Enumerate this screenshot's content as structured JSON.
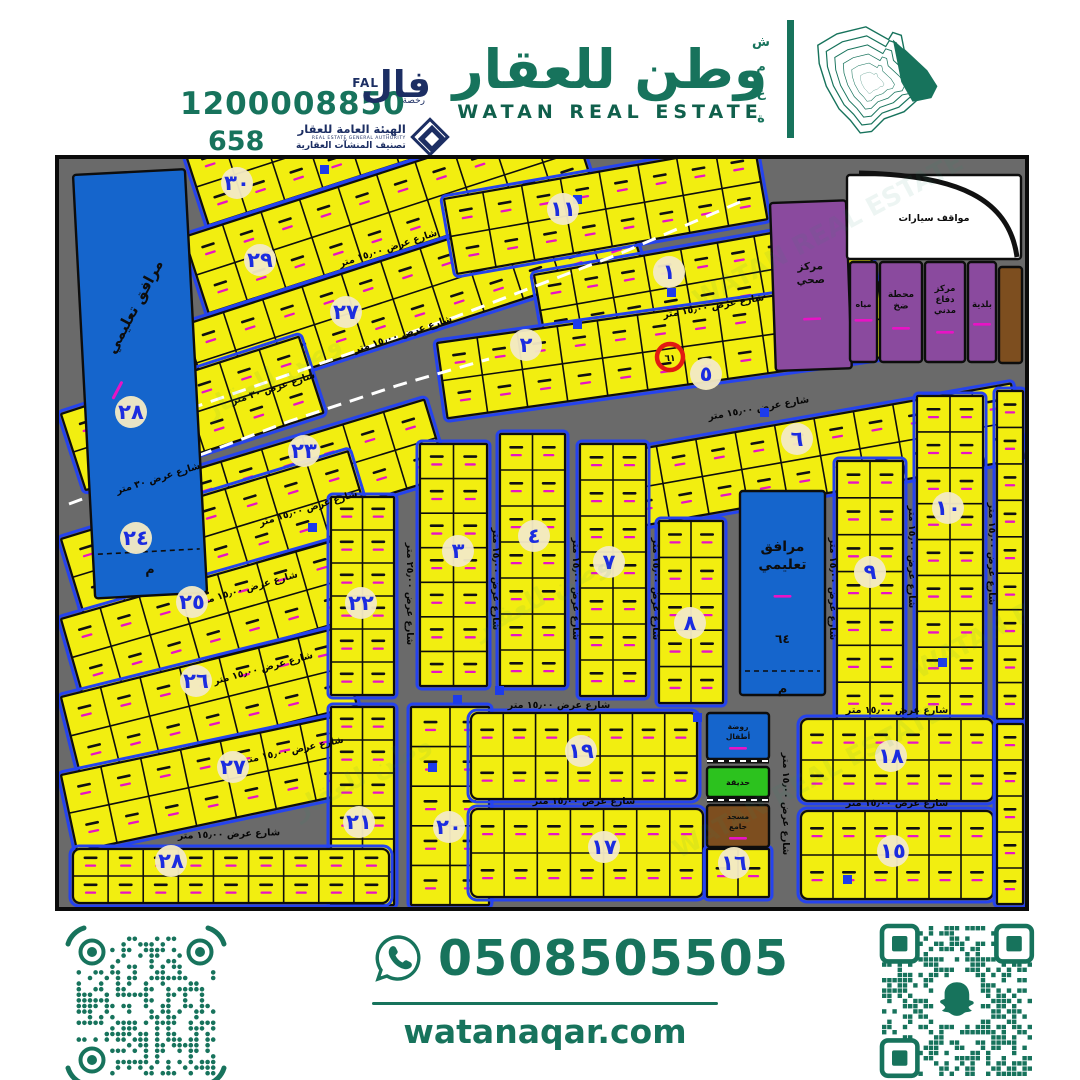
{
  "header": {
    "phone_big": "1200008850",
    "license_number": "658",
    "fal": {
      "ar": "فال",
      "en": "FAL",
      "sub": "رخصة"
    },
    "rega": {
      "line1_ar": "الهيئة العامة للعقار",
      "line1_en": "REAL ESTATE GENERAL AUTHORITY",
      "line2_ar": "تصنيف المنشآت العقارية"
    },
    "brand_ar": "وطن للعقار",
    "brand_en": "WATAN REAL ESTATE",
    "side_word_letters": [
      "ش",
      "م",
      "ع",
      "ة"
    ]
  },
  "footer": {
    "whatsapp_number": "0508505505",
    "website": "watanaqar.com"
  },
  "colors": {
    "brand_green": "#17735c",
    "map_gray": "#6a6a6a",
    "plot_yellow": "#f2ee10",
    "blue_parcel": "#1565cc",
    "purple_parcel": "#8a4a9e",
    "brown_parcel": "#7d4e1f",
    "park_green": "#2cc21e",
    "white_parcel": "#ffffff",
    "block_circle_fill": "#f2e9c5",
    "block_number_blue": "#1b2ce0",
    "area_magenta": "#e813c5",
    "street_edge_blue": "#2543ee",
    "highlight_red": "#e21b12"
  },
  "map": {
    "street_labels_text": {
      "w15": "شارع عرض ١٥٫٠٠ متر",
      "w25": "شارع عرض ٢٥٫٠٠ متر",
      "w30": "شارع عرض ٣٠ متر"
    },
    "street_labels": [
      [
        "w15",
        330,
        92,
        -18
      ],
      [
        "w15",
        345,
        178,
        -18
      ],
      [
        "w30",
        215,
        232,
        -18
      ],
      [
        "w30",
        100,
        322,
        -17
      ],
      [
        "w15",
        250,
        352,
        -17
      ],
      [
        "w15",
        190,
        432,
        -16
      ],
      [
        "w15",
        205,
        512,
        -15
      ],
      [
        "w15",
        235,
        594,
        -12
      ],
      [
        "w15",
        170,
        678,
        -2
      ],
      [
        "w15",
        655,
        150,
        -10
      ],
      [
        "w15",
        700,
        252,
        -10
      ],
      [
        "w15",
        500,
        549,
        0
      ],
      [
        "w15",
        525,
        645,
        0
      ],
      [
        "w15",
        838,
        554,
        0
      ],
      [
        "w15",
        838,
        647,
        0
      ],
      [
        "w25",
        348,
        435,
        90
      ],
      [
        "w15",
        434,
        420,
        90
      ],
      [
        "w15",
        514,
        430,
        90
      ],
      [
        "w15",
        594,
        430,
        90
      ],
      [
        "w15",
        771,
        430,
        90
      ],
      [
        "w15",
        850,
        398,
        90
      ],
      [
        "w15",
        930,
        395,
        90
      ],
      [
        "w15",
        724,
        645,
        90
      ]
    ],
    "block_circles": [
      [
        "٣٠",
        178,
        24
      ],
      [
        "١١",
        504,
        50
      ],
      [
        "٢٩",
        201,
        101
      ],
      [
        "١",
        610,
        113
      ],
      [
        "٢٧",
        287,
        153
      ],
      [
        "٢",
        467,
        186
      ],
      [
        "٥",
        647,
        215
      ],
      [
        "٢٨",
        72,
        253
      ],
      [
        "٢٣",
        245,
        292
      ],
      [
        "٦",
        738,
        280
      ],
      [
        "١٠",
        889,
        349
      ],
      [
        "٢٤",
        77,
        379
      ],
      [
        "٤",
        475,
        377
      ],
      [
        "٣",
        399,
        392
      ],
      [
        "٧",
        550,
        403
      ],
      [
        "٩",
        811,
        413
      ],
      [
        "٢٥",
        133,
        443
      ],
      [
        "٢٢",
        302,
        444
      ],
      [
        "٨",
        631,
        464
      ],
      [
        "٢٦",
        137,
        522
      ],
      [
        "٢٧",
        174,
        608
      ],
      [
        "١٩",
        522,
        592
      ],
      [
        "١٨",
        832,
        597
      ],
      [
        "٢١",
        300,
        663
      ],
      [
        "٢٠",
        390,
        668
      ],
      [
        "١٥",
        834,
        692
      ],
      [
        "١٧",
        545,
        688
      ],
      [
        "١٦",
        675,
        704
      ],
      [
        "٢٨",
        112,
        702
      ]
    ],
    "highlight": {
      "plot_number": "٦١",
      "x": 611,
      "y": 198
    },
    "facilities": {
      "edu_label": "مرافق تعليمي",
      "edu_center_num": "٦٤",
      "meem": "م",
      "health_center": "مركز صحي",
      "water": "مياه",
      "pump_station": "محطة ضخ",
      "civil_defense": "مركز دفاع مدني",
      "municipality": "بلدية",
      "parking": "مواقف سيارات",
      "kindergarten": "روضة أطفال",
      "garden": "حديقة",
      "mosque": "مسجد جامع"
    },
    "watermark": [
      "وطن للعقار",
      "WATAN REAL ESTATE"
    ]
  }
}
